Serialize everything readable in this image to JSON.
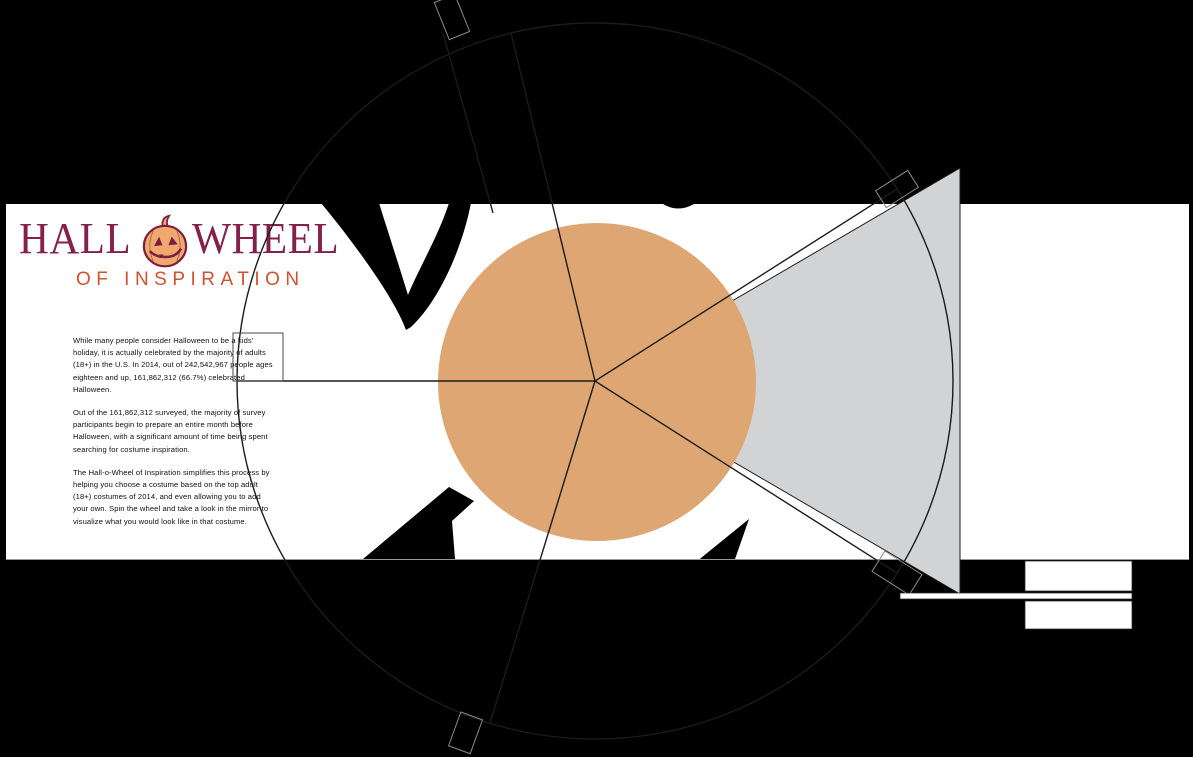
{
  "header": {
    "title_part1": "HALL",
    "title_part2": "WHEEL",
    "subtitle": "OF INSPIRATION",
    "pumpkin_icon": "jack-o-lantern"
  },
  "intro": {
    "paragraphs": [
      "While many people consider Halloween to be a kids' holiday, it is actually celebrated by the majority of adults (18+) in the U.S. In 2014, out of 242,542,967 people ages eighteen and up, 161,862,312 (66.7%) celebrated Halloween.",
      "Out of the 161,862,312 surveyed, the majority of survey participants begin to prepare an entire month before Halloween, with a significant amount of time being spent searching for costume inspiration.",
      "The Hall-o-Wheel of Inspiration simplifies this process by helping you choose a costume based on the top adult (18+) costumes of 2014, and even allowing you to add your own. Spin the wheel and take a look in the mirror to visualize what you would look like in that costume."
    ]
  },
  "wheel": {
    "visible_segments": 5,
    "selected_segment": "right (highlighted gray)",
    "hub_shape": "circle"
  },
  "colors": {
    "bg": "#000000",
    "band": "#ffffff",
    "tan": "#dda672",
    "gray": "#d2d3d5",
    "title": "#84204a",
    "subtitle": "#d2522e",
    "line": "#1b1b1b",
    "pumpkin_body": "#efa96e",
    "pumpkin_face": "#7d1d40"
  }
}
